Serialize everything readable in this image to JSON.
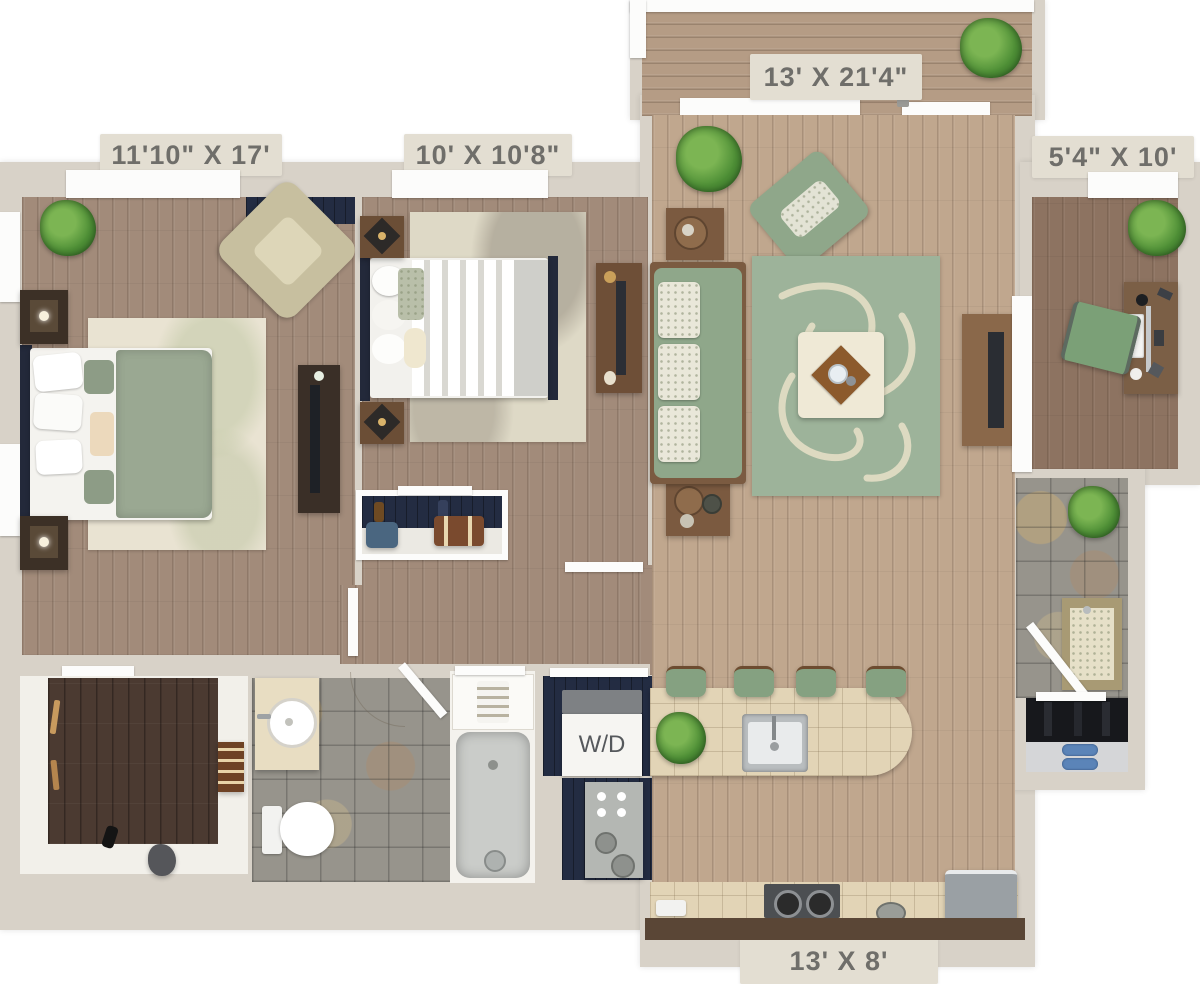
{
  "floorplan": {
    "labels": {
      "balcony": "13' X 21'4\"",
      "bedroom_left": "11'10\" X 17'",
      "bedroom_middle": "10' X 10'8\"",
      "den": "5'4\" X 10'",
      "kitchen": "13' X 8'",
      "washer_dryer": "W/D"
    },
    "palette": {
      "wall": "#d8d2c8",
      "label_text": "#6f6e6a",
      "wood_bedroom": "#a28b7a",
      "wood_living": "#c0a78e",
      "wood_den": "#8d7361",
      "wood_closet": "#4b3a31",
      "deck": "#b59c85",
      "tile_slate": "#97948c",
      "counter_cream": "#e2d4b6",
      "sage_green": "#93ab8e",
      "navy": "#232c42",
      "cream": "#e9e3d2"
    }
  }
}
